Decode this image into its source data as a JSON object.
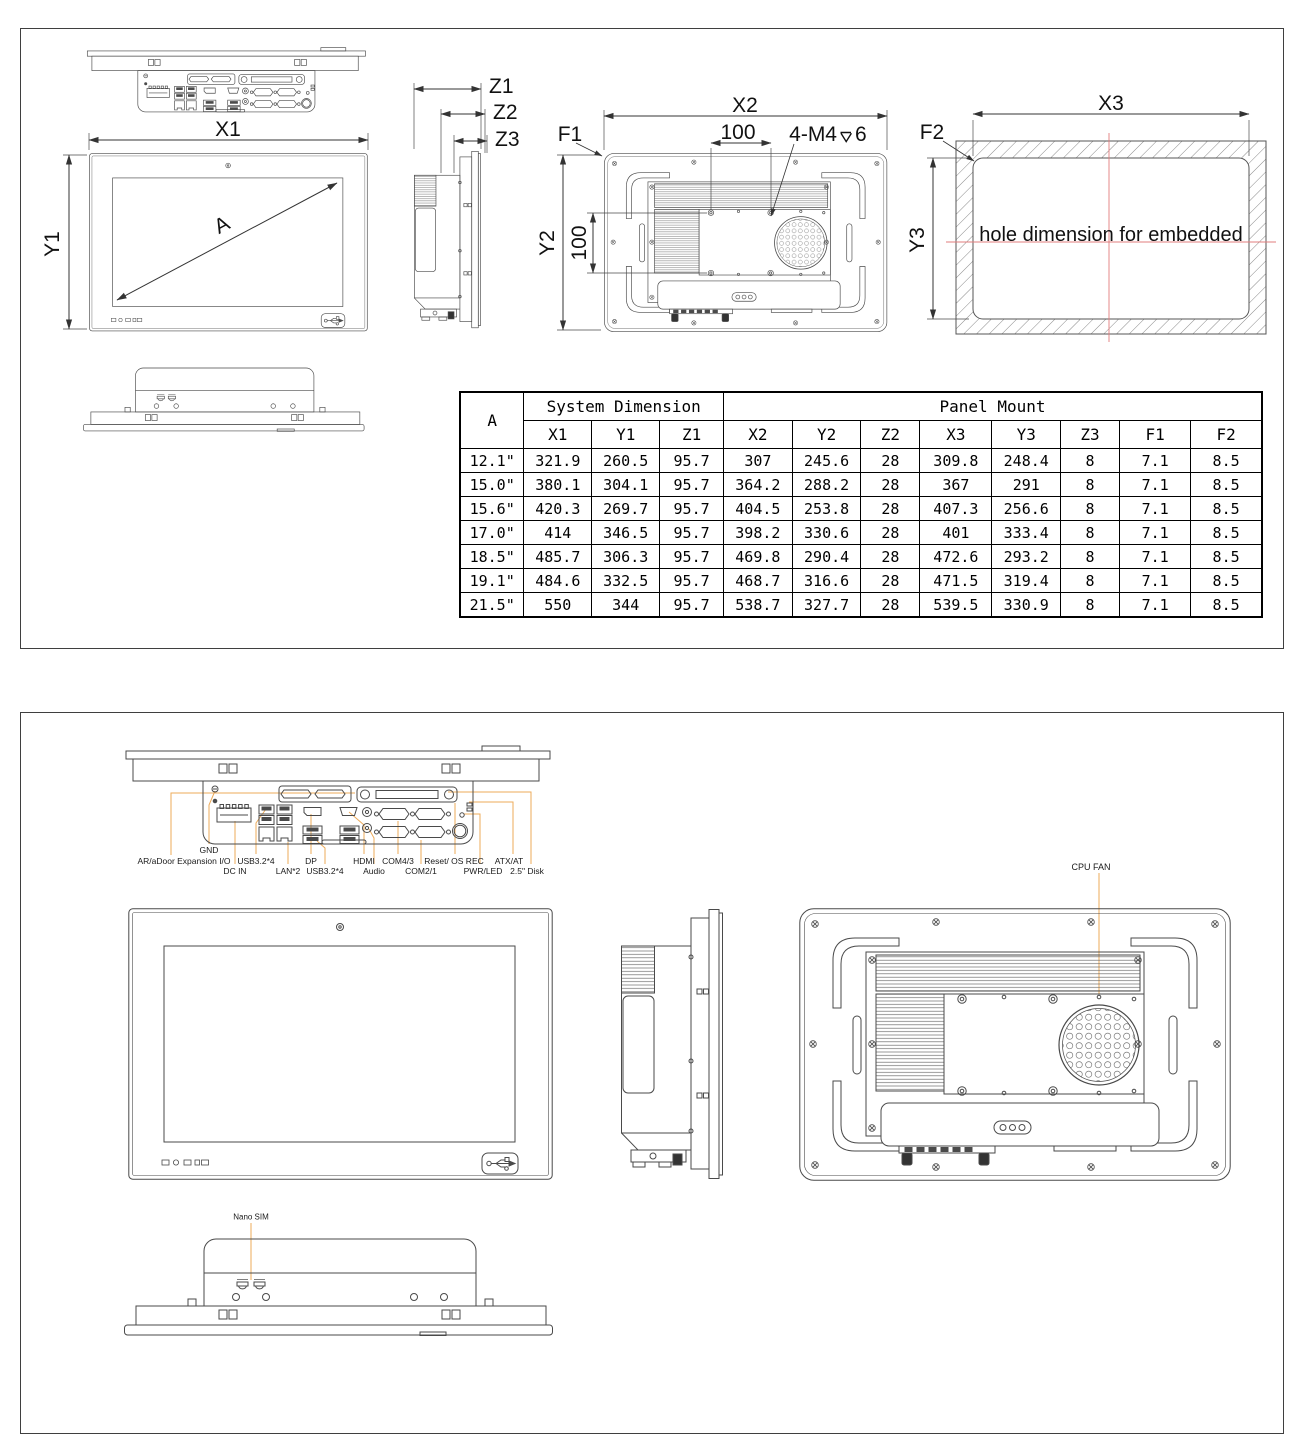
{
  "sheet1": {
    "dims": {
      "x1": "X1",
      "y1": "Y1",
      "a": "A",
      "z1": "Z1",
      "z2": "Z2",
      "z3": "Z3",
      "f1": "F1",
      "x2": "X2",
      "y2": "Y2",
      "vesa_h": "100",
      "vesa_v": "100",
      "thread": "4-M4",
      "thread_depth": "6",
      "f2": "F2",
      "x3": "X3",
      "y3": "Y3",
      "hole_note": "hole dimension for embedded"
    },
    "table": {
      "corner": "A",
      "group1": "System Dimension",
      "group2": "Panel Mount",
      "cols": [
        "X1",
        "Y1",
        "Z1",
        "X2",
        "Y2",
        "Z2",
        "X3",
        "Y3",
        "Z3",
        "F1",
        "F2"
      ],
      "rows": [
        [
          "12.1\"",
          "321.9",
          "260.5",
          "95.7",
          "307",
          "245.6",
          "28",
          "309.8",
          "248.4",
          "8",
          "7.1",
          "8.5"
        ],
        [
          "15.0\"",
          "380.1",
          "304.1",
          "95.7",
          "364.2",
          "288.2",
          "28",
          "367",
          "291",
          "8",
          "7.1",
          "8.5"
        ],
        [
          "15.6\"",
          "420.3",
          "269.7",
          "95.7",
          "404.5",
          "253.8",
          "28",
          "407.3",
          "256.6",
          "8",
          "7.1",
          "8.5"
        ],
        [
          "17.0\"",
          "414",
          "346.5",
          "95.7",
          "398.2",
          "330.6",
          "28",
          "401",
          "333.4",
          "8",
          "7.1",
          "8.5"
        ],
        [
          "18.5\"",
          "485.7",
          "306.3",
          "95.7",
          "469.8",
          "290.4",
          "28",
          "472.6",
          "293.2",
          "8",
          "7.1",
          "8.5"
        ],
        [
          "19.1\"",
          "484.6",
          "332.5",
          "95.7",
          "468.7",
          "316.6",
          "28",
          "471.5",
          "319.4",
          "8",
          "7.1",
          "8.5"
        ],
        [
          "21.5\"",
          "550",
          "344",
          "95.7",
          "538.7",
          "327.7",
          "28",
          "539.5",
          "330.9",
          "8",
          "7.1",
          "8.5"
        ]
      ]
    }
  },
  "sheet2": {
    "io": {
      "gnd": "GND",
      "expansion": "AR/aDoor Expansion I/O",
      "usb_top": "USB3.2*4",
      "dp": "DP",
      "hdmi": "HDMI",
      "com43": "COM4/3",
      "reset": "Reset/ OS REC",
      "atx": "ATX/AT",
      "dcin": "DC IN",
      "lan": "LAN*2",
      "usb_bot": "USB3.2*4",
      "audio": "Audio",
      "com21": "COM2/1",
      "pwrled": "PWR/LED",
      "disk": "2.5\" Disk"
    },
    "cpu_fan": "CPU FAN",
    "nano_sim": "Nano SIM"
  },
  "colors": {
    "line": "#4a4a4a",
    "leader_orange": "#edab5a",
    "centerline_red": "#e17d7d"
  }
}
